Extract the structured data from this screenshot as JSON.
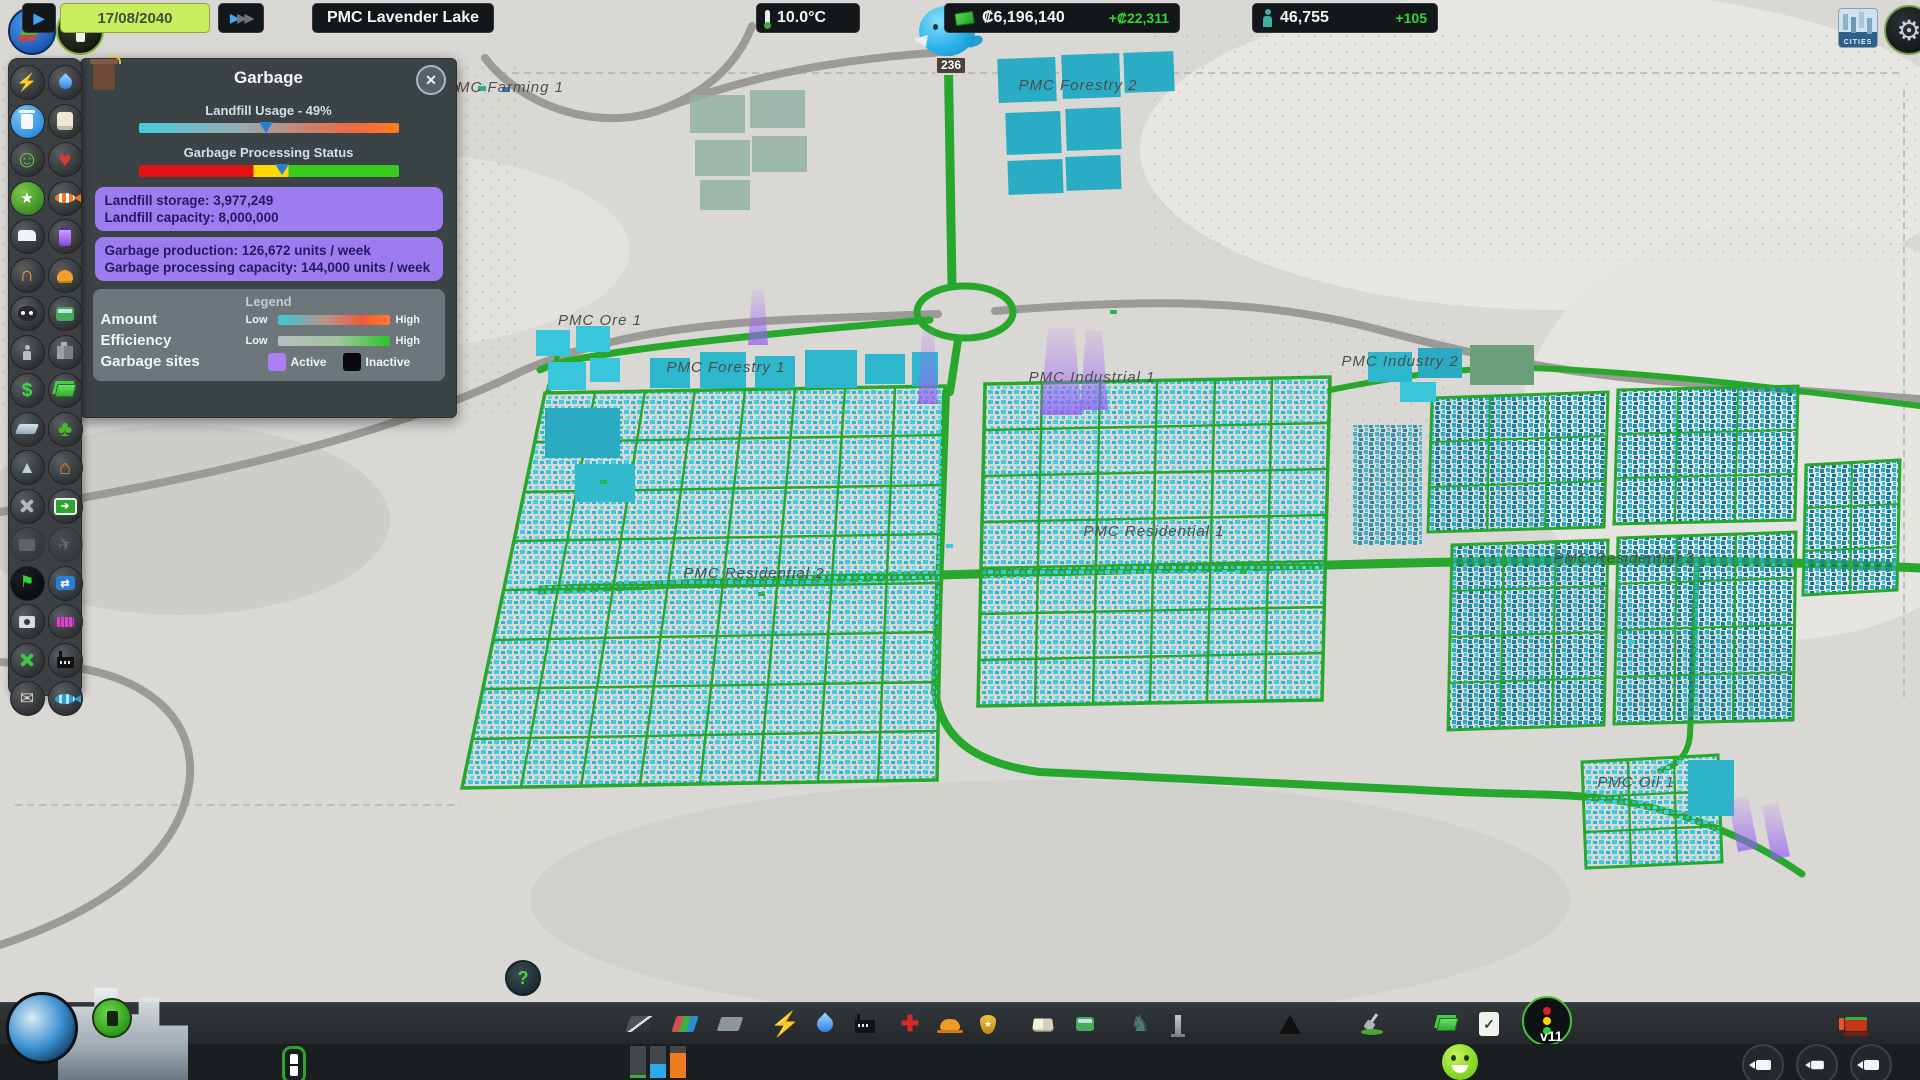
{
  "panel": {
    "title": "Garbage",
    "landfill_usage_label": "Landfill Usage - 49%",
    "usage_pct": 49,
    "processing_label": "Garbage Processing Status",
    "processing_marker_pct": 55,
    "stats": {
      "landfill_storage": "Landfill storage: 3,977,249",
      "landfill_capacity": "Landfill capacity: 8,000,000",
      "production": "Garbage production: 126,672 units / week",
      "processing_capacity": "Garbage processing capacity: 144,000 units / week"
    },
    "legend": {
      "title": "Legend",
      "amount_label": "Amount",
      "efficiency_label": "Efficiency",
      "sites_label": "Garbage sites",
      "low": "Low",
      "high": "High",
      "active": "Active",
      "inactive": "Inactive"
    },
    "colors": {
      "active_site": "#a97ff2",
      "inactive_site": "#0a0a0c"
    }
  },
  "chirper": {
    "badge": "236"
  },
  "map": {
    "labels": [
      "PMC Farming 1",
      "PMC Forestry 2",
      "PMC Ore 1",
      "PMC Forestry 1",
      "PMC Industrial 1",
      "PMC Industry 2",
      "PMC Residential 1",
      "PMC Residential 2",
      "PMC Residential 3",
      "PMC Oil 1"
    ],
    "colors": {
      "road_green": "#27a82c",
      "highway_gray": "#9b9a96",
      "building_cyan": "#3fc9de",
      "beam_purple": "#9a64f0"
    }
  },
  "sidebar": {
    "icons": [
      "electricity",
      "water",
      "garbage",
      "buildings-level",
      "happiness",
      "health",
      "land-value",
      "fishing",
      "deathcare",
      "pollution",
      "noise",
      "fire-safety",
      "crime",
      "transport",
      "population",
      "tourism",
      "economy",
      "income",
      "terrain",
      "park-maintenance",
      "resources",
      "heating",
      "maintenance",
      "traffic-routes",
      "disaster-radio",
      "disaster-helicopter",
      "traffic",
      "routes",
      "entertainment",
      "hotels",
      "industry-maintenance",
      "industry",
      "post",
      "fishing-industry"
    ]
  },
  "toolbar": {
    "icons": [
      "roads",
      "zoning",
      "districts",
      "electricity",
      "water-sewage",
      "garbage",
      "healthcare",
      "fire-department",
      "police",
      "education",
      "transport",
      "parks",
      "monuments",
      "wonders",
      "landscaping",
      "economy",
      "policies",
      "traffic-manager",
      "bulldozer"
    ],
    "tmpe_version": "v11"
  },
  "statusbar": {
    "date": "17/08/2040",
    "city": "PMC Lavender Lake",
    "temp": "10.0°C",
    "funds": "₡6,196,140",
    "funds_delta": "+₡22,311",
    "population": "46,755",
    "population_delta": "+105"
  }
}
